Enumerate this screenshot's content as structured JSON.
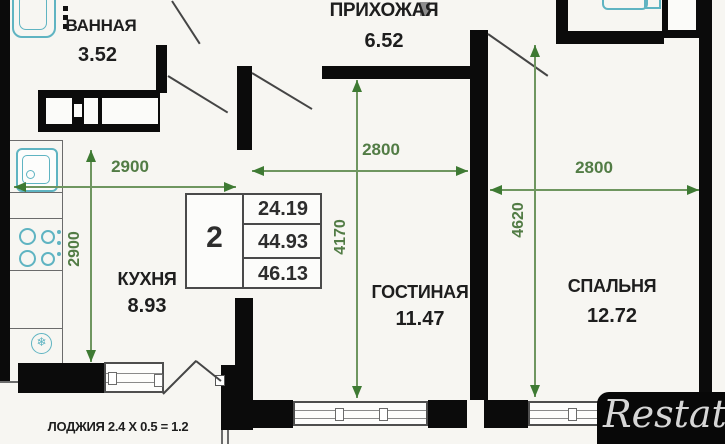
{
  "plan": {
    "rooms": [
      {
        "name": "ВАННАЯ",
        "area": "3.52"
      },
      {
        "name": "ПРИХОЖАЯ",
        "area": "6.52"
      },
      {
        "name": "КУХНЯ",
        "area": "8.93"
      },
      {
        "name": "ГОСТИНАЯ",
        "area": "11.47"
      },
      {
        "name": "СПАЛЬНЯ",
        "area": "12.72"
      }
    ],
    "summary_table": {
      "room_count": "2",
      "values": [
        "24.19",
        "44.93",
        "46.13"
      ]
    },
    "dimensions_mm": {
      "kitchen_width": "2900",
      "kitchen_depth": "2900",
      "living_width": "2800",
      "living_height": "4170",
      "bedroom_width": "2800",
      "bedroom_height": "4620"
    },
    "loggia_label": "ЛОДЖИЯ 2.4 X 0.5 = 1.2",
    "watermark": "Restate",
    "colors": {
      "wall": "#0b0b0b",
      "dimension_green": "#4e7c40",
      "fixture_teal": "#5fb4c2",
      "background": "#f7f6f2"
    }
  }
}
